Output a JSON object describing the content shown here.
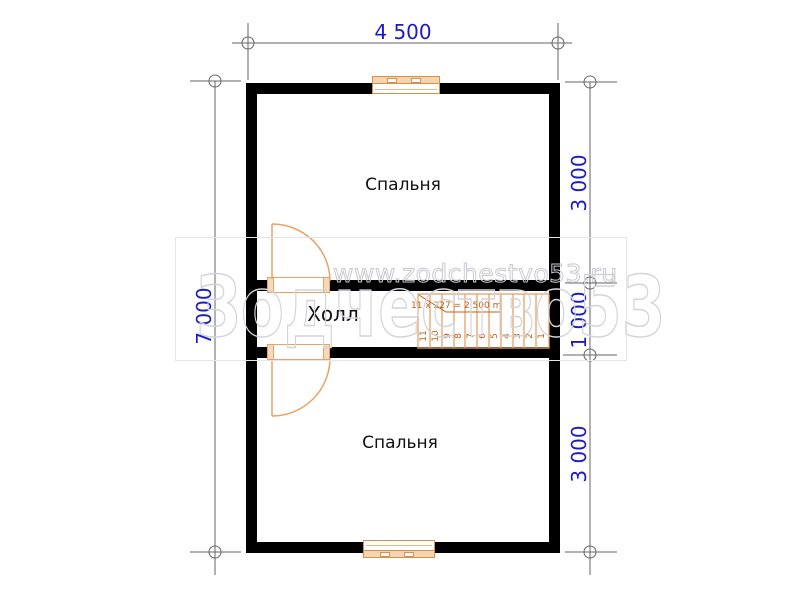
{
  "plan": {
    "title_note": "floor plan",
    "rooms": {
      "bedroom_top": "Спальня",
      "hall": "Холл",
      "bedroom_bottom": "Спальня"
    },
    "dimensions": {
      "top_width": "4 500",
      "left_height": "7 000",
      "right_top": "3 000",
      "right_middle": "1 000",
      "right_bottom": "3 000"
    },
    "stairs": {
      "annotation": "11 x 227 = 2,500 m",
      "step_numbers": [
        "11",
        "10",
        "9",
        "8",
        "7",
        "6",
        "5",
        "4",
        "3",
        "2",
        "1"
      ]
    },
    "watermark": {
      "url_text": "www.zodchestvo53.ru",
      "brand_text": "Зодчество53"
    },
    "colors": {
      "wall": "#000000",
      "dimension_text": "#1b1bc7",
      "dimension_lines": "#666666",
      "joinery_orange": "#e8a266",
      "window_fill": "#f5d5b0",
      "stair_text": "#c2601a",
      "watermark": "#c9c9d1"
    }
  }
}
